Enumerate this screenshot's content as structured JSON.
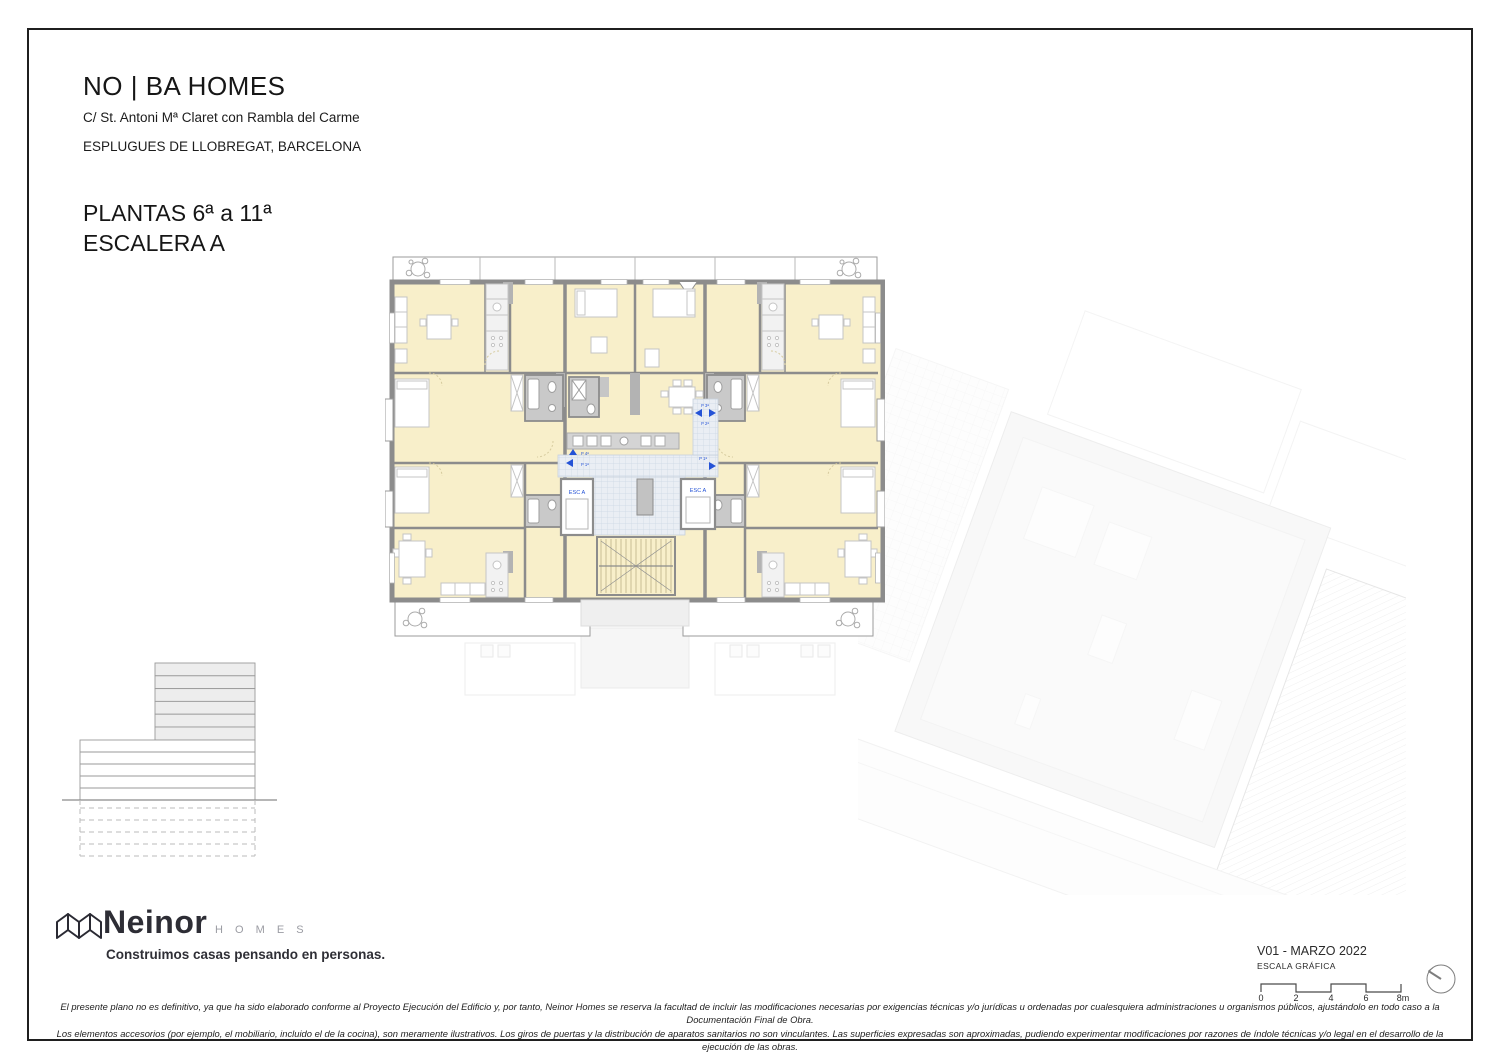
{
  "header": {
    "project_title": "NO | BA HOMES",
    "address_line": "C/ St. Antoni Mª Claret con Rambla del Carme",
    "city_line": "ESPLUGUES DE LLOBREGAT, BARCELONA",
    "plan_title": "PLANTAS 6ª a 11ª",
    "stair_title": "ESCALERA A"
  },
  "plan": {
    "core_labels": {
      "left": "ESC A",
      "right": "ESC A"
    },
    "door_tags": {
      "tag1": "P 4ª",
      "tag2": "P 1ª",
      "tag3": "P 3ª",
      "tag4": "P 2ª",
      "tag5": "P 1ª"
    },
    "colors": {
      "room_fill": "#F8EFCA",
      "wall_gray": "#8C8C8C",
      "bath_floor": "#C9C9C9",
      "corridor_fill": "#EAEEF4",
      "accent_blue": "#2553D6",
      "context_gray": "#F3F3F3"
    }
  },
  "footer": {
    "brand": {
      "name": "Neinor",
      "word": "H O M E S",
      "tagline": "Construimos casas pensando en personas."
    },
    "version": "V01 - MARZO 2022",
    "scale_label": "ESCALA GRÁFICA",
    "scale_ticks": [
      "0",
      "2",
      "4",
      "6",
      "8m"
    ],
    "disclaimer_line1": "El presente plano no es definitivo, ya que ha sido elaborado conforme al Proyecto Ejecución del Edificio y, por tanto, Neinor Homes se reserva la facultad de incluir las modificaciones necesarias por exigencias técnicas y/o jurídicas u ordenadas por cualesquiera administraciones u organismos públicos, ajustándolo en todo caso a la Documentación Final de Obra.",
    "disclaimer_line2": "Los elementos accesorios (por ejemplo, el mobiliario, incluido el de la cocina), son meramente ilustrativos. Los giros de puertas y la distribución de aparatos sanitarios no son vinculantes. Las superficies expresadas son aproximadas, pudiendo experimentar modificaciones por razones de índole técnicas y/o legal en el desarrollo de la ejecución de las obras."
  }
}
